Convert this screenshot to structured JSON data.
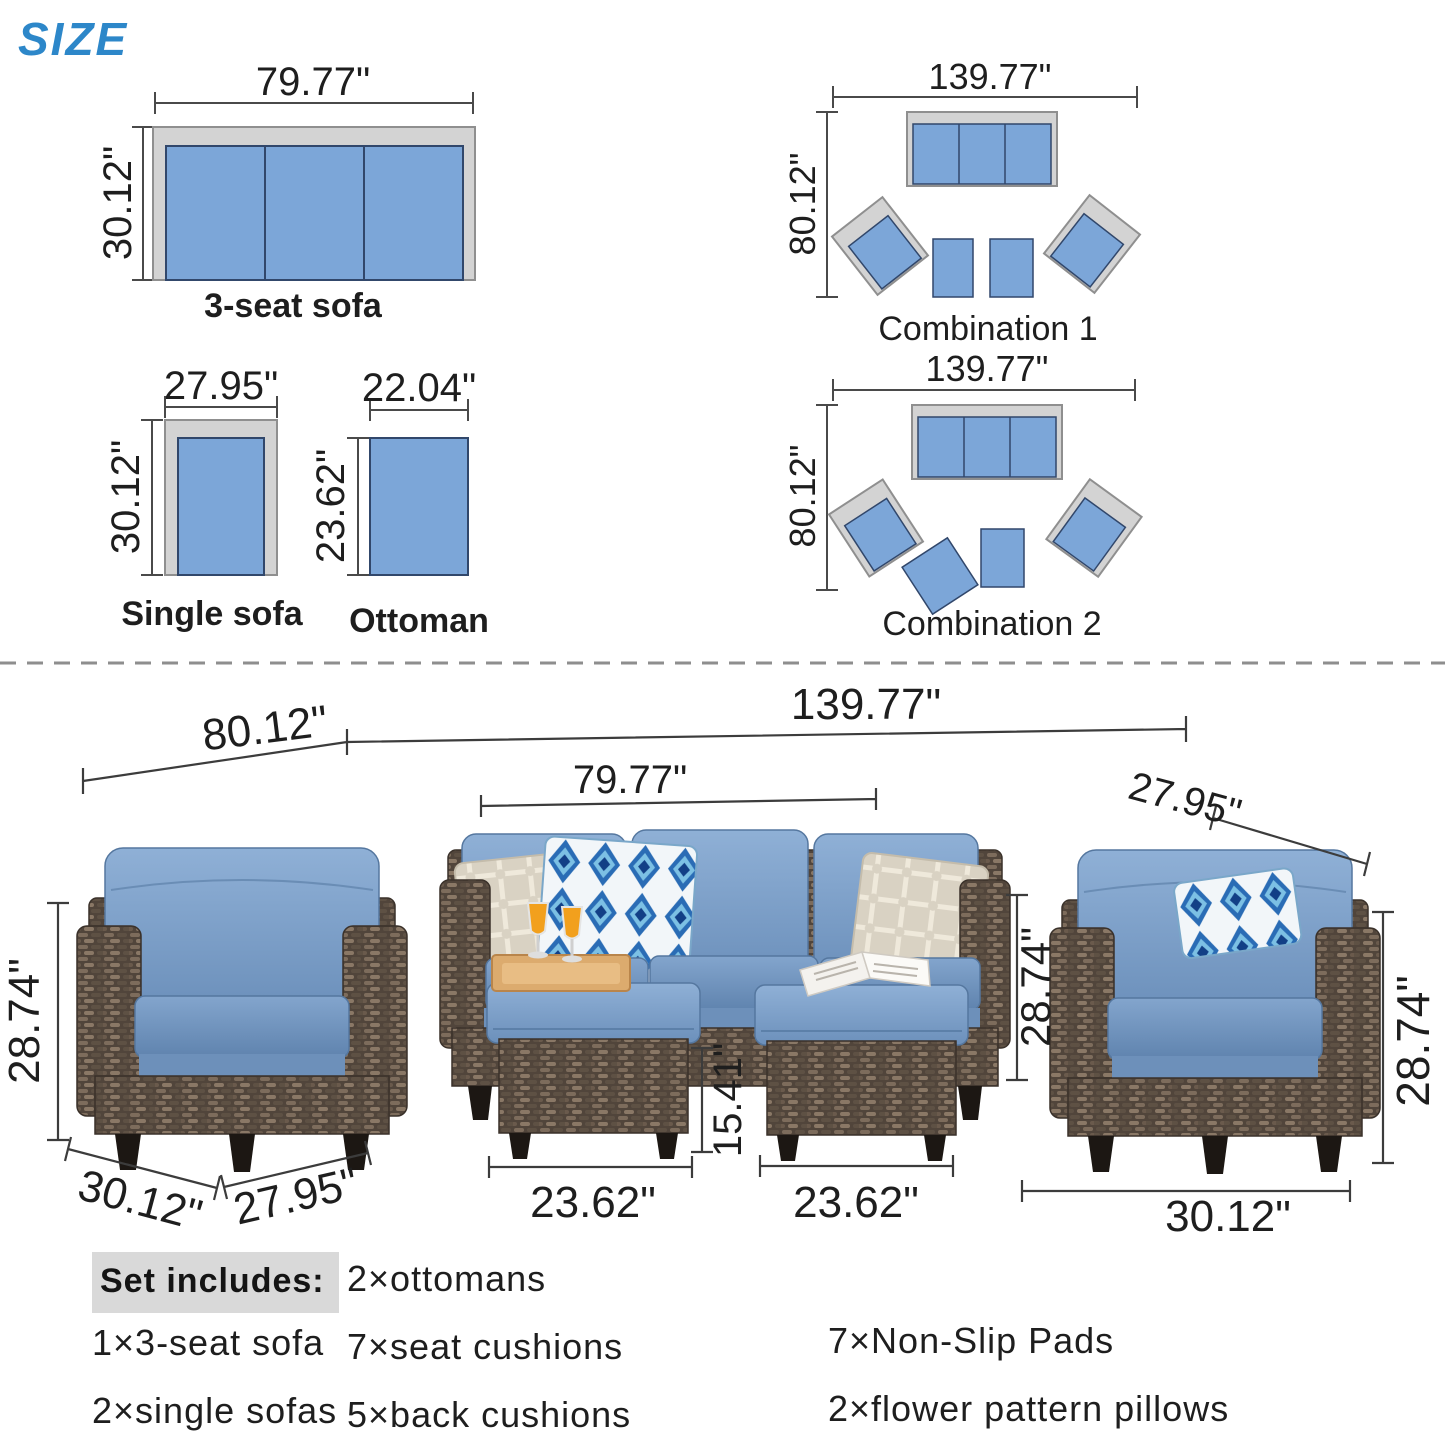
{
  "title": "SIZE",
  "top": {
    "sofa3": {
      "caption": "3-seat sofa",
      "width": "79.77\"",
      "depth": "30.12\""
    },
    "single": {
      "caption": "Single sofa",
      "width": "27.95\"",
      "depth": "30.12\""
    },
    "ottoman": {
      "caption": "Ottoman",
      "width": "22.04\"",
      "depth": "23.62\""
    },
    "combo1": {
      "caption": "Combination 1",
      "width": "139.77\"",
      "depth": "80.12\""
    },
    "combo2": {
      "caption": "Combination 2",
      "width": "139.77\"",
      "depth": "80.12\""
    }
  },
  "scene": {
    "left_group_span": "80.12\"",
    "total_span": "139.77\"",
    "sofa_span": "79.77\"",
    "right_chair_top_width": "27.95\"",
    "left_chair_height": "28.74\"",
    "sofa_height": "28.74\"",
    "right_chair_height": "28.74\"",
    "ottoman_height": "15.41\"",
    "left_chair_depth": "30.12\"",
    "left_chair_width": "27.95\"",
    "left_ottoman_width": "23.62\"",
    "right_ottoman_width": "23.62\"",
    "right_chair_depth": "30.12\""
  },
  "includes": {
    "heading": "Set includes:",
    "col1": [
      "1×3-seat sofa",
      "2×single sofas"
    ],
    "col2": [
      "2×ottomans",
      "7×seat cushions",
      "5×back cushions"
    ],
    "col3": [
      "7×Non-Slip Pads",
      "2×flower pattern pillows"
    ]
  },
  "colors": {
    "accent_blue": "#2d87c9",
    "diagram_blue": "#7ca6d8",
    "diagram_navy": "#31476b",
    "frame_gray": "#d3d3d3",
    "cushion_blue": "#7b9dc7",
    "wicker_brown": "#5a4d42",
    "dim_line": "#3c3c3c",
    "highlight_gray": "#d9d9d9"
  }
}
